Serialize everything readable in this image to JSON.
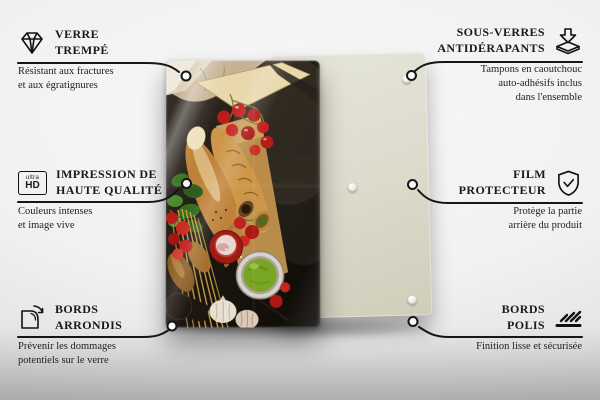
{
  "colors": {
    "background": "#efefef",
    "back_panel": "#dbdacb",
    "connector_line": "#161616",
    "text": "#1a1a1a",
    "tomato_red": "#bf1f1a",
    "pesto_green": "#79a524"
  },
  "product": {
    "front_panel": "glass panel printed with Italian food photo",
    "back_panel_pads_visible": 3
  },
  "features": [
    {
      "id": "verre-trempe",
      "icon": "diamond-icon",
      "title_line1": "VERRE",
      "title_line2": "TREMPÉ",
      "description_line1": "Résistant aux fractures",
      "description_line2": "et aux égratignures"
    },
    {
      "id": "sous-verres-antiderapants",
      "icon": "pad-arrow-icon",
      "title_line1": "SOUS-VERRES",
      "title_line2": "ANTIDÉRAPANTS",
      "description_line1": "Tampons en caoutchouc",
      "description_line2": "auto-adhésifs inclus",
      "description_line3": "dans l'ensemble"
    },
    {
      "id": "impression-haute-qualite",
      "icon": "ultra-hd-icon",
      "icon_text_small": "ultra",
      "icon_text_big": "HD",
      "title_line1": "IMPRESSION DE",
      "title_line2": "HAUTE QUALITÉ",
      "description_line1": "Couleurs intenses",
      "description_line2": "et image vive"
    },
    {
      "id": "film-protecteur",
      "icon": "shield-check-icon",
      "title_line1": "FILM",
      "title_line2": "PROTECTEUR",
      "description_line1": "Protège la partie",
      "description_line2": "arrière du produit"
    },
    {
      "id": "bords-arrondis",
      "icon": "rounded-corner-icon",
      "title_line1": "BORDS",
      "title_line2": "ARRONDIS",
      "description_line1": "Prévenir les dommages",
      "description_line2": "potentiels sur le verre"
    },
    {
      "id": "bords-polis",
      "icon": "polished-edge-icon",
      "title_line1": "BORDS",
      "title_line2": "POLIS",
      "description_line1": "Finition lisse et sécurisée"
    }
  ]
}
